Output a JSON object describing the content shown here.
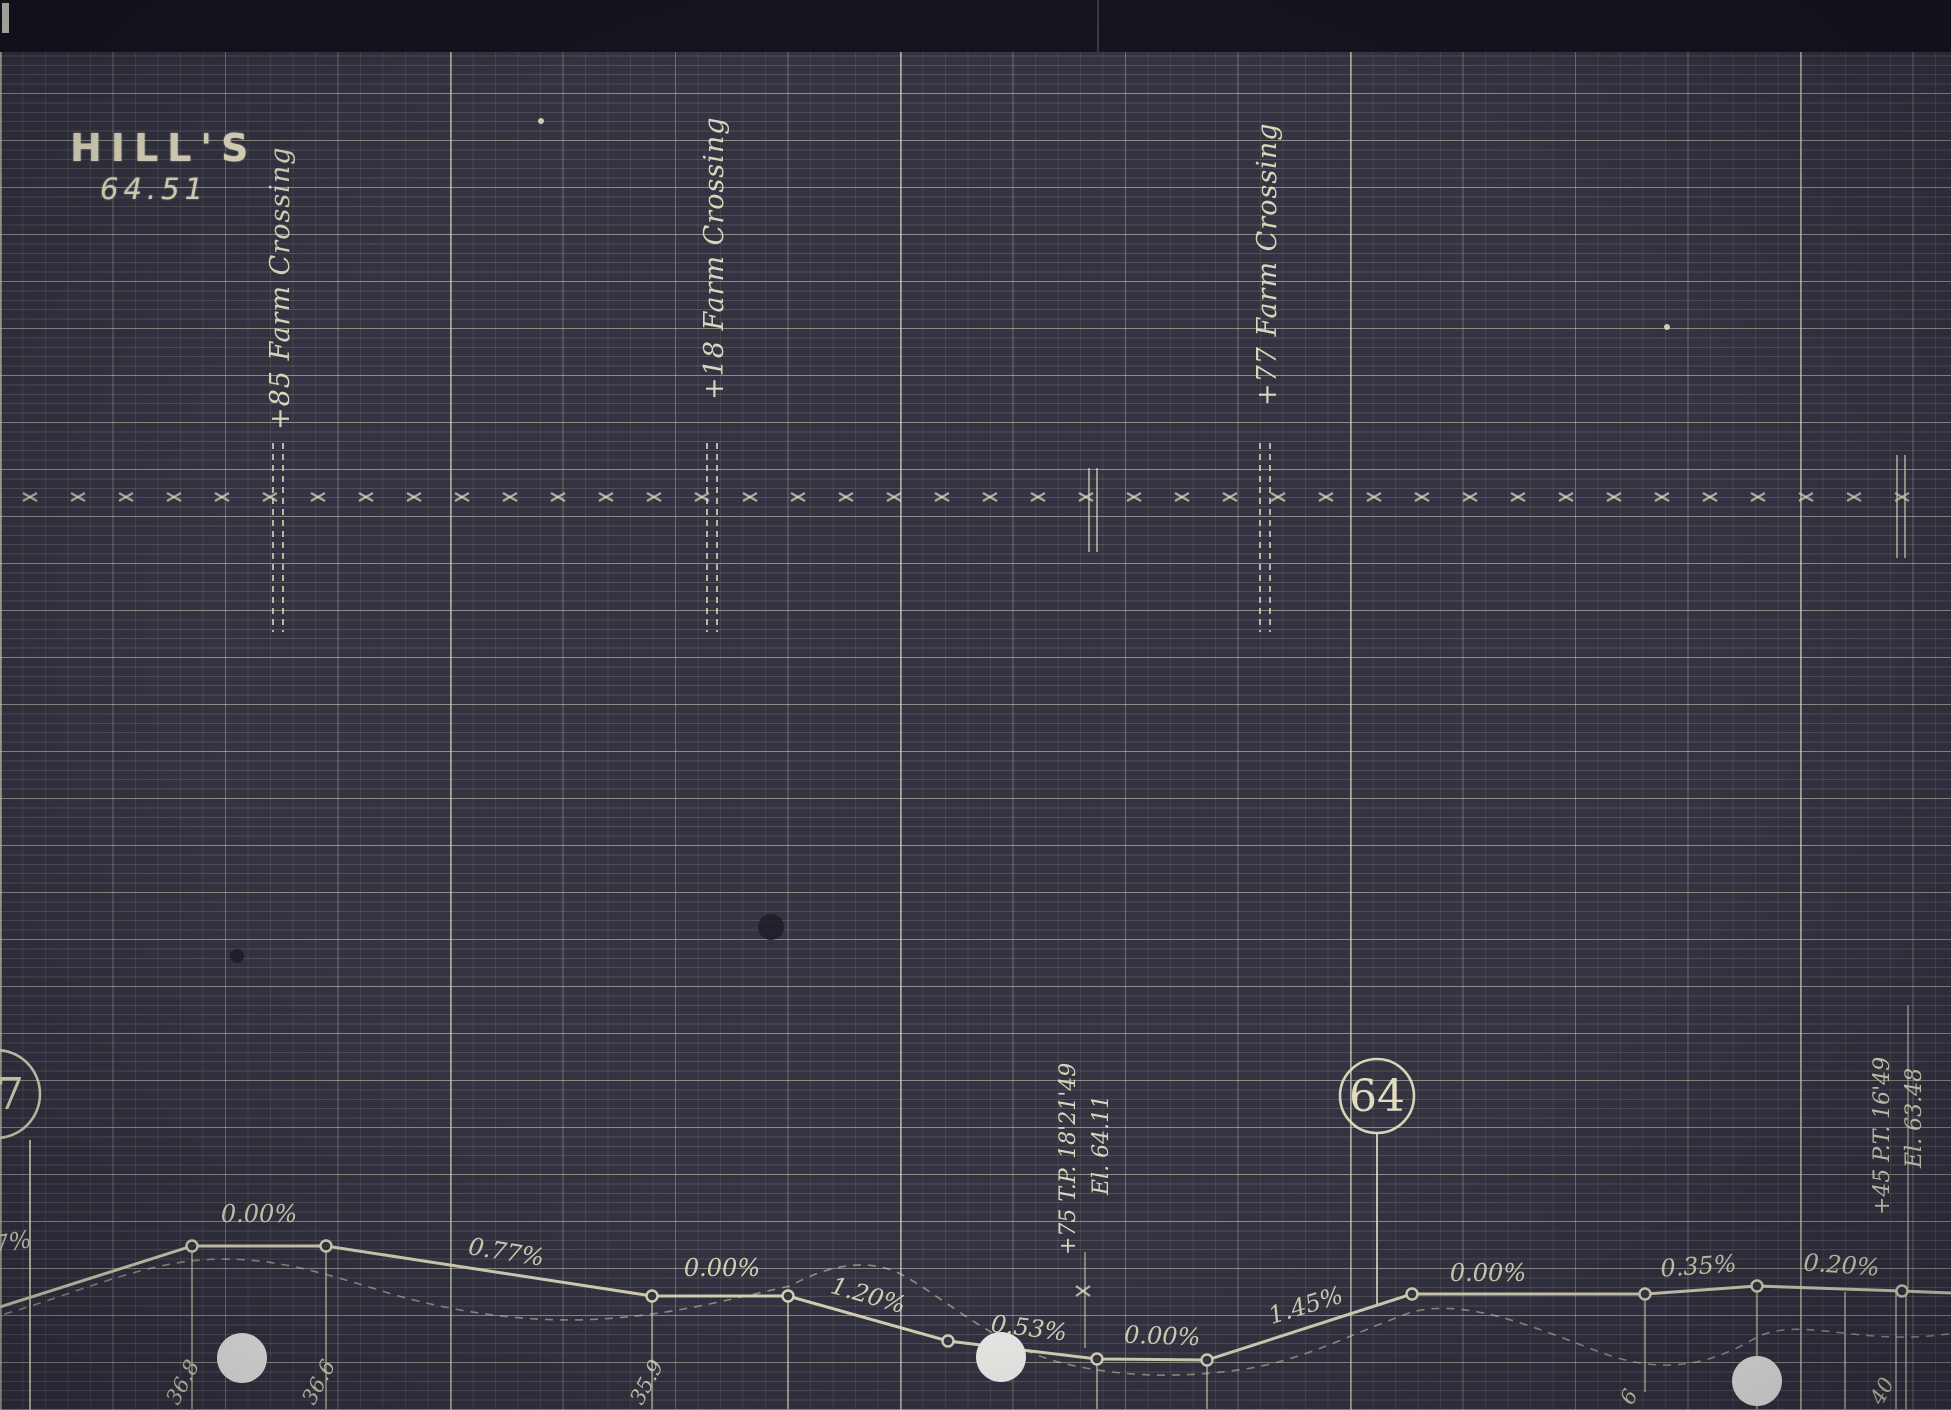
{
  "page": {
    "width": 1951,
    "height": 1410,
    "bg": "#333341",
    "band_color": "#14141c",
    "ink": "#e3ddc0",
    "hole_color": "#eef1ec"
  },
  "title": {
    "name": "HILL'S",
    "number": "64.51"
  },
  "crossings": [
    {
      "label": "+85 Farm Crossing",
      "x": 278,
      "label_bottom": 430,
      "tick_top": 443,
      "tick_bottom": 632
    },
    {
      "label": "+18 Farm Crossing",
      "x": 712,
      "label_bottom": 400,
      "tick_top": 443,
      "tick_bottom": 632
    },
    {
      "label": "+77 Farm Crossing",
      "x": 1265,
      "label_bottom": 406,
      "tick_top": 443,
      "tick_bottom": 632
    }
  ],
  "stations": [
    {
      "label": "37",
      "cx": -4,
      "cy": 1094,
      "r": 44,
      "drop_x": 30,
      "drop_y1": 1140,
      "drop_y2": 1410
    },
    {
      "label": "64",
      "cx": 1377,
      "cy": 1096,
      "r": 37,
      "drop_x": 1377,
      "drop_y1": 1133,
      "drop_y2": 1304
    }
  ],
  "annotations": [
    {
      "text": "+75 T.P. 18'21'49",
      "x": 1075,
      "y": 1255
    },
    {
      "text": "El. 64.11",
      "x": 1108,
      "y": 1195
    },
    {
      "text": "+45 P.T. 16'49",
      "x": 1889,
      "y": 1215
    },
    {
      "text": "El. 63.48",
      "x": 1921,
      "y": 1168
    }
  ],
  "annotation_lines": [
    {
      "x": 1085,
      "y1": 1252,
      "y2": 1348
    },
    {
      "x": 1908,
      "y1": 1005,
      "y2": 1288
    }
  ],
  "alignment": {
    "tick_y": 497,
    "tick_x0": 30,
    "tick_x1": 1945,
    "tick_step": 48,
    "extra_ticks": [
      {
        "x": 1083,
        "y": 1291
      }
    ],
    "right_double_ticks": [
      {
        "x": 1901,
        "y1": 455,
        "y2": 558
      },
      {
        "x": 1093,
        "y1": 468,
        "y2": 552
      }
    ]
  },
  "chart_data": {
    "type": "line",
    "title": "Railroad track profile — grade line with percent grades",
    "profile_points": [
      [
        0,
        1307
      ],
      [
        192,
        1246
      ],
      [
        326,
        1246
      ],
      [
        652,
        1296
      ],
      [
        788,
        1296
      ],
      [
        948,
        1341
      ],
      [
        1097,
        1359
      ],
      [
        1207,
        1360
      ],
      [
        1412,
        1294
      ],
      [
        1645,
        1294
      ],
      [
        1757,
        1286
      ],
      [
        1902,
        1291
      ],
      [
        1951,
        1293
      ]
    ],
    "node_indices": [
      1,
      2,
      3,
      4,
      5,
      6,
      7,
      8,
      9,
      10,
      11
    ],
    "grade_labels": [
      {
        "text": "7%",
        "x": 14,
        "y": 1250,
        "angle": -10
      },
      {
        "text": "0.00%",
        "x": 259,
        "y": 1222,
        "angle": 0
      },
      {
        "text": "0.77%",
        "x": 505,
        "y": 1260,
        "angle": 9
      },
      {
        "text": "0.00%",
        "x": 722,
        "y": 1276,
        "angle": 0
      },
      {
        "text": "1.20%",
        "x": 866,
        "y": 1303,
        "angle": 16
      },
      {
        "text": "0.53%",
        "x": 1028,
        "y": 1336,
        "angle": 7
      },
      {
        "text": "0.00%",
        "x": 1162,
        "y": 1344,
        "angle": 2
      },
      {
        "text": "1.45%",
        "x": 1308,
        "y": 1313,
        "angle": -17
      },
      {
        "text": "0.00%",
        "x": 1488,
        "y": 1281,
        "angle": 0
      },
      {
        "text": "0.35%",
        "x": 1699,
        "y": 1274,
        "angle": -4
      },
      {
        "text": "0.20%",
        "x": 1841,
        "y": 1273,
        "angle": 4
      }
    ],
    "drop_lines": [
      [
        192,
        1246,
        1409
      ],
      [
        326,
        1246,
        1409
      ],
      [
        652,
        1296,
        1409
      ],
      [
        788,
        1296,
        1409
      ],
      [
        1097,
        1359,
        1409
      ],
      [
        1207,
        1360,
        1409
      ],
      [
        1645,
        1294,
        1392
      ],
      [
        1757,
        1286,
        1409
      ],
      [
        1845,
        1292,
        1409
      ],
      [
        1896,
        1291,
        1409
      ],
      [
        1906,
        1291,
        1409
      ]
    ],
    "elevation_labels": [
      {
        "text": "36.8",
        "x": 186
      },
      {
        "text": "36.6",
        "x": 322
      },
      {
        "text": "35.9",
        "x": 650
      },
      {
        "text": "6",
        "x": 1640
      },
      {
        "text": "40",
        "x": 1890
      }
    ],
    "ground_path": "M -10 1318 C 60 1300, 130 1266, 200 1260 C 270 1255, 320 1272, 395 1295 C 470 1316, 545 1324, 615 1318 C 680 1313, 735 1298, 790 1286 C 830 1264, 872 1256, 908 1278 C 950 1303, 1000 1347, 1062 1363 C 1124 1378, 1185 1378, 1245 1369 C 1305 1360, 1355 1332, 1412 1312 C 1470 1297, 1545 1332, 1605 1354 C 1660 1373, 1705 1367, 1752 1340 C 1798 1312, 1862 1350, 1960 1332"
  },
  "punch_holes": [
    [
      242,
      1358,
      25
    ],
    [
      1001,
      1357,
      25
    ],
    [
      1757,
      1381,
      25
    ]
  ],
  "dark_spots": [
    [
      771,
      927,
      13
    ],
    [
      237,
      956,
      7
    ]
  ],
  "light_specks": [
    [
      1667,
      327,
      3
    ],
    [
      541,
      121,
      3
    ]
  ]
}
